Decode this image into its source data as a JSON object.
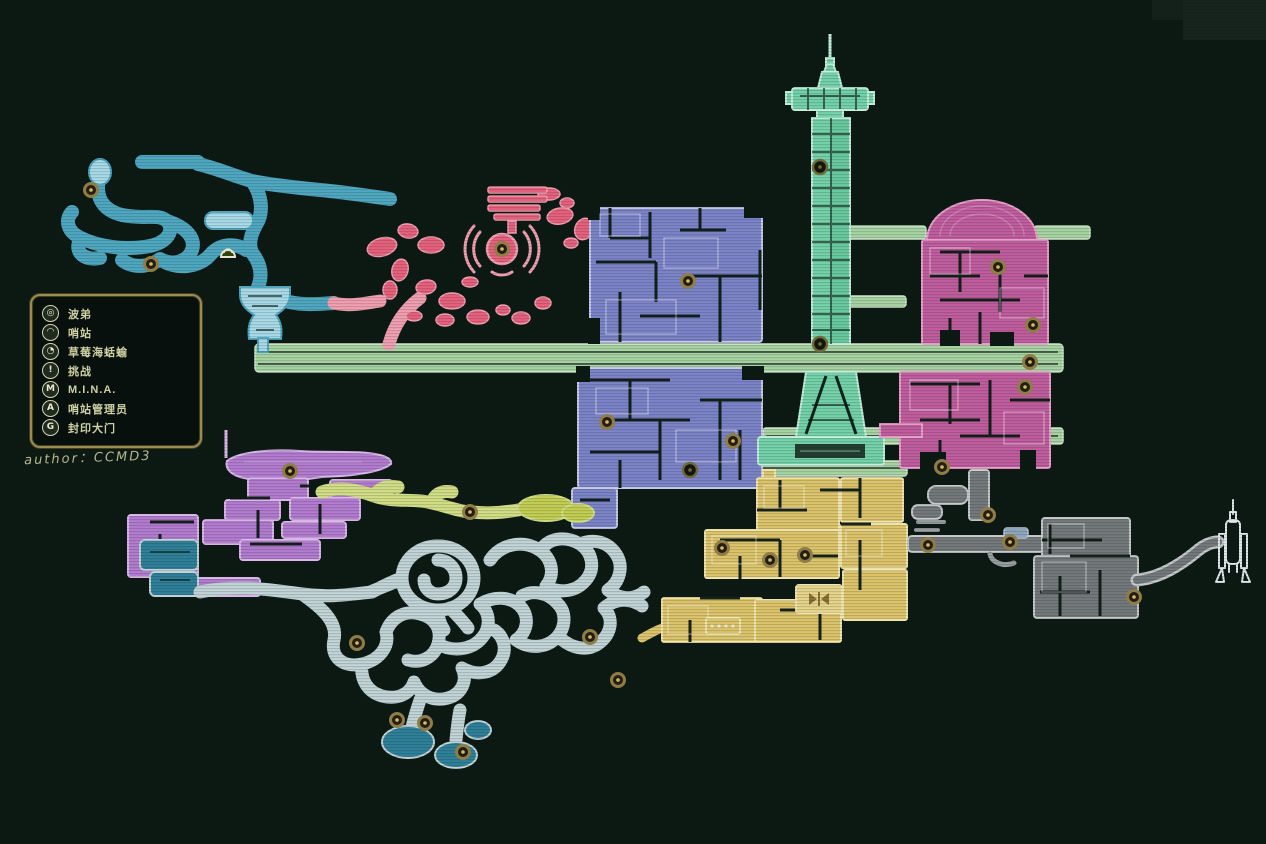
{
  "legend": {
    "items": [
      {
        "label": "波弟",
        "icon": "buddy-icon",
        "glyph": "◎"
      },
      {
        "label": "哨站",
        "icon": "outpost-icon",
        "glyph": "◠"
      },
      {
        "label": "草莓海蛞蝓",
        "icon": "sea-slug-icon",
        "glyph": "◔"
      },
      {
        "label": "挑战",
        "icon": "challenge-icon",
        "glyph": "!"
      },
      {
        "label": "M.I.N.A.",
        "icon": "mina-icon",
        "glyph": "M"
      },
      {
        "label": "哨站管理员",
        "icon": "station-manager-icon",
        "glyph": "A"
      },
      {
        "label": "封印大门",
        "icon": "sealed-gate-icon",
        "glyph": "G"
      }
    ]
  },
  "credit": "author：CCMD3",
  "map": {
    "background": "#0c1913",
    "corner_patch": "#16241d",
    "regions": {
      "nw": {
        "name": "northwest-caves",
        "fill": "#a9dbe9",
        "outline": "#4fa8c2"
      },
      "pink": {
        "name": "ripple-grove",
        "fill": "#e7617e",
        "outline": "#f2a0b1"
      },
      "indigo": {
        "name": "central-complex",
        "fill": "#7d84c9",
        "outline": "#c7cbe8"
      },
      "mint": {
        "name": "radio-tower",
        "fill": "#74d3aa",
        "outline": "#c4efdc"
      },
      "bridge": {
        "name": "sky-bridges",
        "fill": "#a8d4a4",
        "outline": "#cfe8cb"
      },
      "magenta": {
        "name": "dome-district",
        "fill": "#c25da0",
        "outline": "#e8a2ca"
      },
      "orchid": {
        "name": "west-harbor",
        "fill": "#b47cd1",
        "outline": "#dcb9ec"
      },
      "olive": {
        "name": "green-fields",
        "fill": "#a9bb42",
        "outline": "#d3df86"
      },
      "deep": {
        "name": "deep-caverns",
        "fill": "#2f8099",
        "outline": "#c3d5d8"
      },
      "gold": {
        "name": "sand-mines",
        "fill": "#dec56b",
        "outline": "#f2e6af"
      },
      "gray": {
        "name": "scrapyard",
        "fill": "#75797c",
        "outline": "#c6cacc"
      },
      "rocket": {
        "name": "rocket-site",
        "fill": "none",
        "outline": "#e2e9ec"
      }
    },
    "marker_styles": {
      "node": {
        "ring": "#8f7c46",
        "center": "#241f12",
        "dot": "#d3bc6d"
      },
      "outpost": {
        "ring": "#e8e4cf",
        "center": "#31430f",
        "dot": "#e8e4cf"
      },
      "gate": {
        "ring": "#6f6a3a",
        "center": "#141710",
        "dot": "#6f6a3a"
      }
    },
    "markers": [
      {
        "x": 91,
        "y": 190,
        "t": "node"
      },
      {
        "x": 151,
        "y": 264,
        "t": "node"
      },
      {
        "x": 228,
        "y": 254,
        "t": "outpost"
      },
      {
        "x": 502,
        "y": 249,
        "t": "node"
      },
      {
        "x": 688,
        "y": 281,
        "t": "node"
      },
      {
        "x": 820,
        "y": 167,
        "t": "gate"
      },
      {
        "x": 820,
        "y": 344,
        "t": "gate"
      },
      {
        "x": 690,
        "y": 470,
        "t": "gate"
      },
      {
        "x": 607,
        "y": 422,
        "t": "node"
      },
      {
        "x": 733,
        "y": 441,
        "t": "node"
      },
      {
        "x": 290,
        "y": 471,
        "t": "node"
      },
      {
        "x": 470,
        "y": 512,
        "t": "node"
      },
      {
        "x": 998,
        "y": 267,
        "t": "node"
      },
      {
        "x": 1033,
        "y": 325,
        "t": "node"
      },
      {
        "x": 1030,
        "y": 362,
        "t": "node"
      },
      {
        "x": 1025,
        "y": 387,
        "t": "node"
      },
      {
        "x": 942,
        "y": 467,
        "t": "node"
      },
      {
        "x": 722,
        "y": 548,
        "t": "node"
      },
      {
        "x": 770,
        "y": 560,
        "t": "node"
      },
      {
        "x": 805,
        "y": 555,
        "t": "node"
      },
      {
        "x": 928,
        "y": 545,
        "t": "node"
      },
      {
        "x": 988,
        "y": 515,
        "t": "node"
      },
      {
        "x": 1010,
        "y": 542,
        "t": "node"
      },
      {
        "x": 1134,
        "y": 597,
        "t": "node"
      },
      {
        "x": 357,
        "y": 643,
        "t": "node"
      },
      {
        "x": 590,
        "y": 637,
        "t": "node"
      },
      {
        "x": 618,
        "y": 680,
        "t": "node"
      },
      {
        "x": 397,
        "y": 720,
        "t": "node"
      },
      {
        "x": 425,
        "y": 723,
        "t": "node"
      },
      {
        "x": 463,
        "y": 752,
        "t": "node"
      }
    ]
  }
}
